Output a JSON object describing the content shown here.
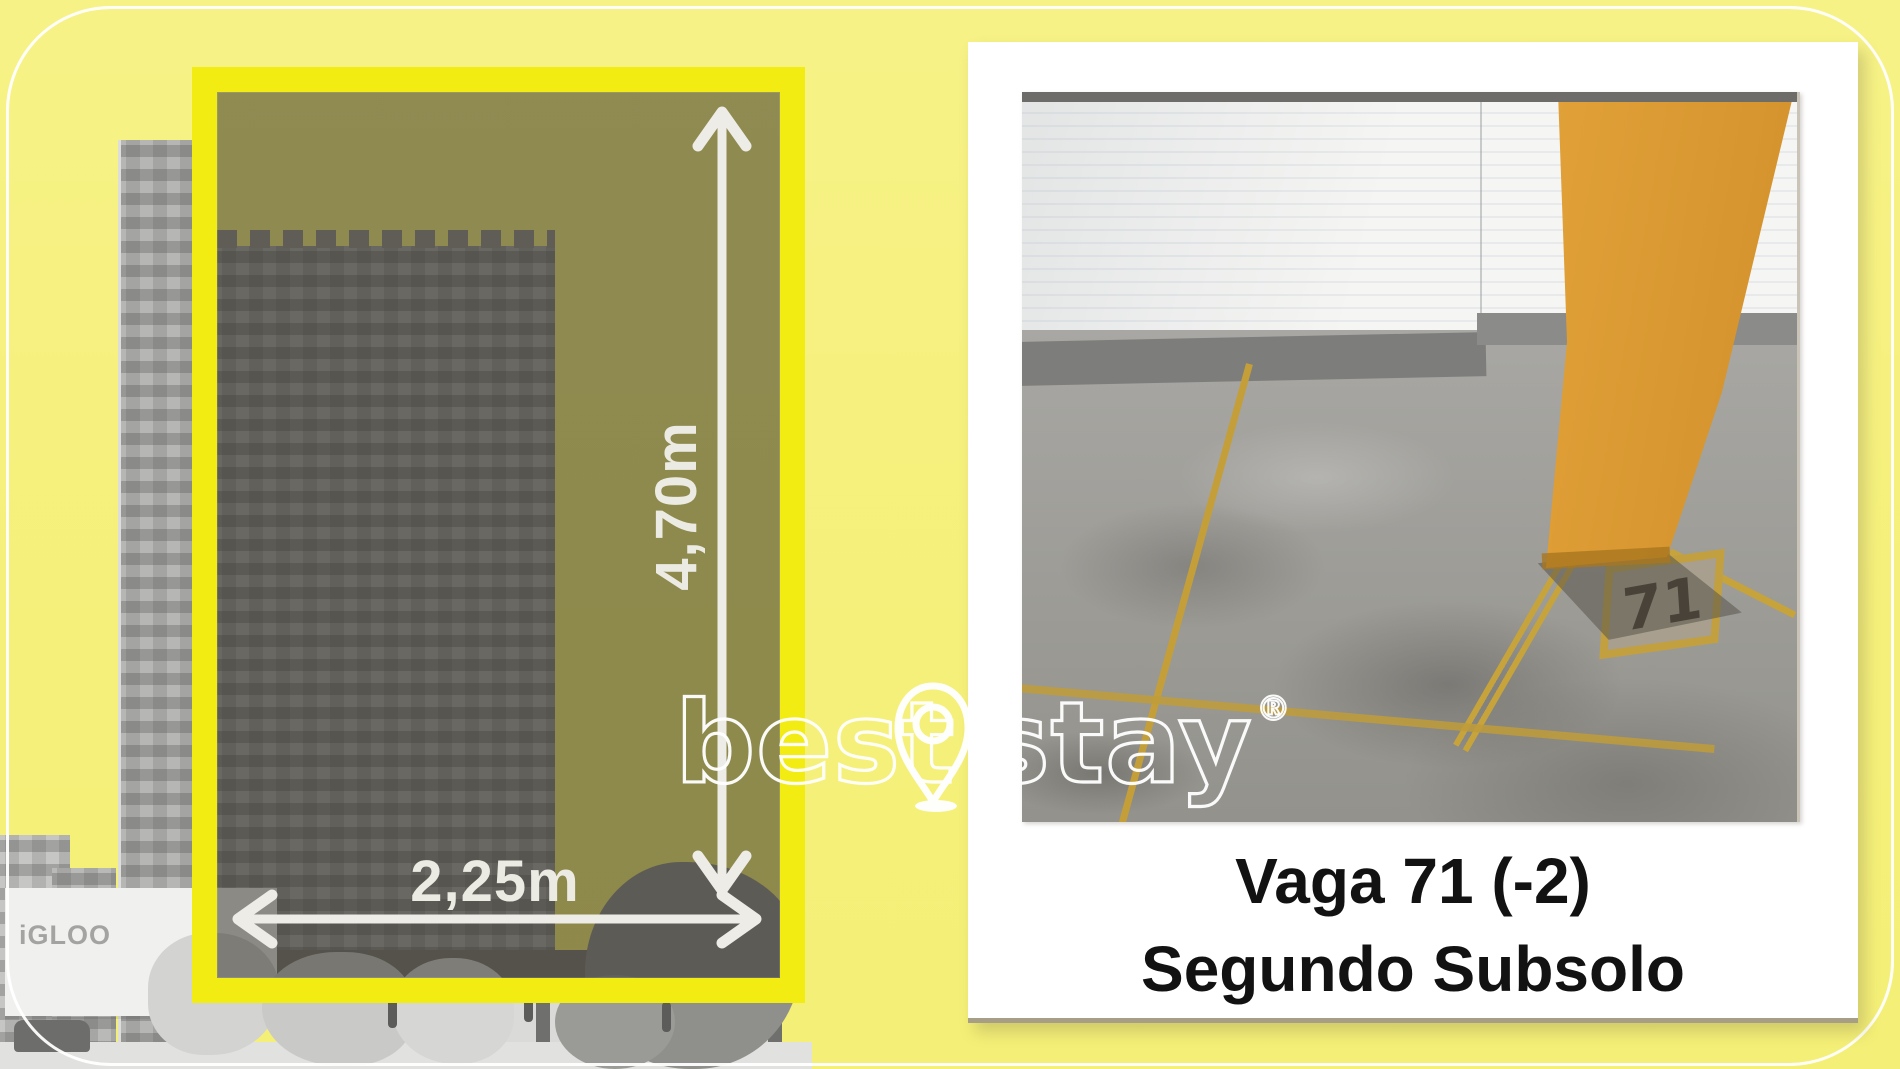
{
  "left_panel": {
    "height_label": "4,70m",
    "width_label": "2,25m",
    "building_sign": "iGLOO"
  },
  "watermark": {
    "word1": "best",
    "word2": "stay",
    "registered": "®",
    "icon": "location-pin"
  },
  "photo_card": {
    "floor_number": "71",
    "caption_line1": "Vaga 71 (-2)",
    "caption_line2": "Segundo Subsolo"
  },
  "colors": {
    "background_yellow": "#f6f17c",
    "frame_yellow": "#f2ec12",
    "frame_overlay_olive": "#87836c",
    "dimension_text": "#ecebe3",
    "caption_text": "#121212",
    "pillar_orange": "#e6a63c",
    "floor_line_yellow": "#c7a33b",
    "polaroid_white": "#ffffff"
  }
}
